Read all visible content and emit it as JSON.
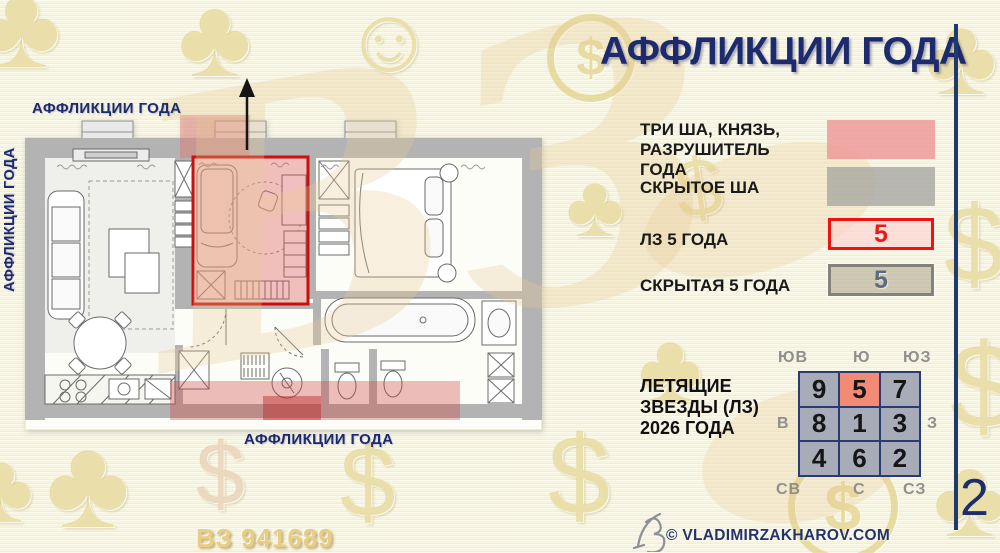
{
  "page": {
    "title": "АФФЛИКЦИИ ГОДА",
    "page_number": "2"
  },
  "plan": {
    "label_top": "АФФЛИКЦИИ ГОДА",
    "label_left": "АФФЛИКЦИИ ГОДА",
    "label_bottom": "АФФЛИКЦИИ ГОДА"
  },
  "legend": {
    "items": [
      {
        "label": "ТРИ ША, КНЯЗЬ, РАЗРУШИТЕЛЬ ГОДА",
        "swatch": "pink",
        "swatch_color": "#ee9595"
      },
      {
        "label": "СКРЫТОЕ ША",
        "swatch": "gray",
        "swatch_color": "#a8a7a2"
      },
      {
        "label": "ЛЗ 5 ГОДА",
        "swatch": "red-outline",
        "swatch_color": "#fbd6d6",
        "border_color": "#ee1212",
        "value": "5",
        "value_color": "#e51c1c"
      },
      {
        "label": "СКРЫТАЯ 5 ГОДА",
        "swatch": "gray-outline",
        "swatch_color": "#9c9278",
        "border_color": "#84837b",
        "value": "5",
        "value_color": "#5c6c80"
      }
    ]
  },
  "flying_stars": {
    "label": "ЛЕТЯЩИЕ ЗВЕЗДЫ (ЛЗ) 2026 ГОДА",
    "cells": [
      "9",
      "5",
      "7",
      "8",
      "1",
      "3",
      "4",
      "6",
      "2"
    ],
    "highlight_cell": "5",
    "highlight_color": "#f28a76",
    "directions": {
      "top_left": "ЮВ",
      "top_center": "Ю",
      "top_right": "ЮЗ",
      "mid_left": "В",
      "mid_right": "З",
      "bottom_left": "СВ",
      "bottom_center": "С",
      "bottom_right": "СЗ"
    }
  },
  "footer": {
    "copyright": "© VLADIMIRZAKHAROV.COM",
    "stamp": "ВЗ 941689"
  },
  "watermarks": {
    "monogram": "ВЗ",
    "clover": "♣",
    "smiley": "☺",
    "dollar": "$",
    "coin_dollar": "$"
  },
  "colors": {
    "navy": "#1c2d6e",
    "red_accent": "#cc1111",
    "pink_zone": "#ee9595",
    "gray_zone": "#a8a7a2",
    "gold": "#e0c878"
  }
}
